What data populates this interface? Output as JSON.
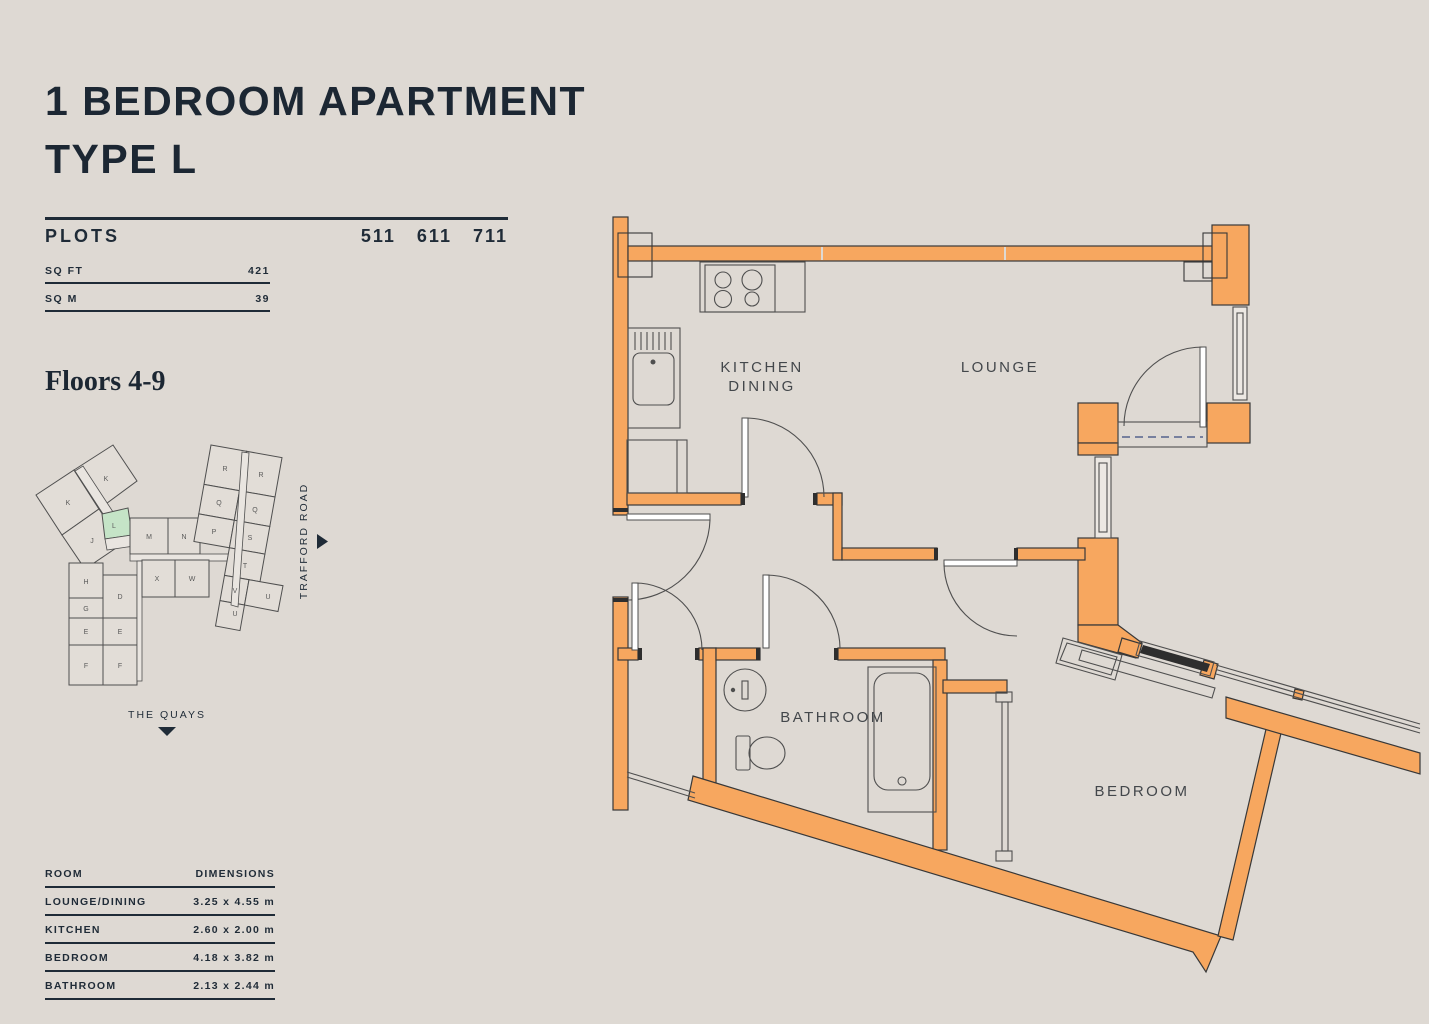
{
  "page": {
    "title_line1": "1 BEDROOM APARTMENT",
    "title_line2": "TYPE L",
    "plots_label": "PLOTS",
    "plots_values": "511 611 711",
    "sqft_label": "SQ FT",
    "sqft_value": "421",
    "sqm_label": "SQ M",
    "sqm_value": "39",
    "floors_label": "Floors 4-9"
  },
  "colors": {
    "background": "#DED9D3",
    "ink": "#1F2B37",
    "wall_orange": "#F7A75F",
    "highlight_green": "#C5E4C7",
    "balcony_dash_blue": "#55628C",
    "glazing_dark": "#2E2E2E"
  },
  "siteplan": {
    "road_label": "TRAFFORD ROAD",
    "quays_label": "THE QUAYS",
    "highlighted_unit": "L",
    "units": [
      {
        "label": "K",
        "x": 33,
        "y": 100
      },
      {
        "label": "K",
        "x": 71,
        "y": 76
      },
      {
        "label": "J",
        "x": 57,
        "y": 138
      },
      {
        "label": "L",
        "x": 79,
        "y": 123,
        "highlight": true
      },
      {
        "label": "M",
        "x": 114,
        "y": 134
      },
      {
        "label": "N",
        "x": 149,
        "y": 134
      },
      {
        "label": "R",
        "x": 190,
        "y": 66
      },
      {
        "label": "R",
        "x": 226,
        "y": 72
      },
      {
        "label": "Q",
        "x": 184,
        "y": 100
      },
      {
        "label": "Q",
        "x": 220,
        "y": 107
      },
      {
        "label": "P",
        "x": 179,
        "y": 129
      },
      {
        "label": "S",
        "x": 215,
        "y": 135
      },
      {
        "label": "T",
        "x": 210,
        "y": 163
      },
      {
        "label": "V",
        "x": 200,
        "y": 188
      },
      {
        "label": "U",
        "x": 200,
        "y": 211
      },
      {
        "label": "U",
        "x": 233,
        "y": 194
      },
      {
        "label": "X",
        "x": 122,
        "y": 176
      },
      {
        "label": "W",
        "x": 157,
        "y": 176
      },
      {
        "label": "H",
        "x": 51,
        "y": 179
      },
      {
        "label": "D",
        "x": 85,
        "y": 194
      },
      {
        "label": "G",
        "x": 51,
        "y": 206
      },
      {
        "label": "E",
        "x": 51,
        "y": 229
      },
      {
        "label": "E",
        "x": 85,
        "y": 229
      },
      {
        "label": "F",
        "x": 51,
        "y": 263
      },
      {
        "label": "F",
        "x": 85,
        "y": 263
      }
    ]
  },
  "floorplan": {
    "labels": {
      "kitchen_line1": "KITCHEN",
      "kitchen_line2": "DINING",
      "lounge": "LOUNGE",
      "bathroom": "BATHROOM",
      "bedroom": "BEDROOM"
    }
  },
  "dimensions_table": {
    "headers": [
      "ROOM",
      "DIMENSIONS"
    ],
    "rows": [
      [
        "LOUNGE/DINING",
        "3.25 x 4.55 m"
      ],
      [
        "KITCHEN",
        "2.60 x 2.00 m"
      ],
      [
        "BEDROOM",
        "4.18 x 3.82 m"
      ],
      [
        "BATHROOM",
        "2.13 x 2.44 m"
      ]
    ]
  }
}
